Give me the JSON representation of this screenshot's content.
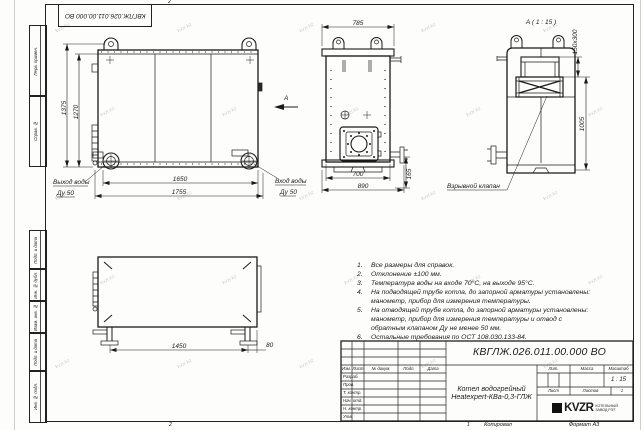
{
  "sheet": {
    "stamp_text": "КВГЛЖ.026.011.00.000 ВО",
    "watermark": "kvzr.kz",
    "fold_mark_top": "2",
    "fold_mark_bottom": "2",
    "footer": {
      "fold_num": "1",
      "copied": "Копировал",
      "format": "Формат А3"
    },
    "margin_labels": {
      "top": [
        "Перв. примен.",
        "Справ. №"
      ],
      "bottom": [
        "Подп. и дата",
        "Инв. № дубл.",
        "Взам. инв. №",
        "Подп. и дата",
        "Инв. № подл."
      ]
    }
  },
  "front_view": {
    "dim_height_outer": "1375",
    "dim_height_inner": "1270",
    "dim_width_inner": "1650",
    "dim_width_outer": "1755",
    "outlet_label": "Выход воды",
    "outlet_size": "Ду 50",
    "inlet_label": "Вход воды",
    "inlet_size": "Ду 50",
    "view_arrow_label": "А"
  },
  "side_view": {
    "dim_width_top": "785",
    "dim_width_inner": "700",
    "dim_width_outer": "890",
    "dim_pipe_height": "165"
  },
  "detail_view": {
    "title": "А ( 1 : 15 )",
    "dim_hatch": "150х300",
    "dim_height": "1005",
    "valve_label": "Взрывной клапан"
  },
  "plan_view": {
    "dim_legs": "1450",
    "dim_offset": "80"
  },
  "notes": {
    "items": [
      {
        "num": "1.",
        "text": "Все размеры для справок."
      },
      {
        "num": "2.",
        "text": "Отклонение ±100 мм."
      },
      {
        "num": "3.",
        "text": "Температура воды на входе 70°С, на выходе 95°С."
      },
      {
        "num": "4.",
        "text": "На подводящей трубе котла, до запорной арматуры установлены: манометр, прибор для измерения температуры."
      },
      {
        "num": "5.",
        "text": "На отводящей трубе котла, до запорной арматуры установлены: манометр, прибор для измерения температуры и отвод с обратным клапаном Ду не менее 50 мм."
      },
      {
        "num": "6.",
        "text": "Остальные требования по ОСТ 108.030.133-84."
      }
    ]
  },
  "title_block": {
    "doc_number": "КВГЛЖ.026.011.00.000 ВО",
    "product_name_line1": "Котел водогрейный",
    "product_name_line2": "Heatexpert-КВа-0,3-ГЛЖ",
    "cols": {
      "izm": "Изм.",
      "list": "Лист",
      "doc": "№ докум.",
      "podp": "Подп.",
      "data": "Дата"
    },
    "rows": [
      "Разраб.",
      "Пров.",
      "Т. контр.",
      "Нач. отд.",
      "Н. контр.",
      "Утв."
    ],
    "lit_label": "Лит.",
    "mass_label": "Масса",
    "scale_label": "Масштаб",
    "scale_value": "1 : 15",
    "sheet_label": "Лист",
    "sheets_label": "Листов",
    "sheets_value": "1",
    "logo_text": "KVZR",
    "company_line1": "КОТЕЛЬНЫЙ",
    "company_line2": "ЗАВОД РЭТ"
  }
}
